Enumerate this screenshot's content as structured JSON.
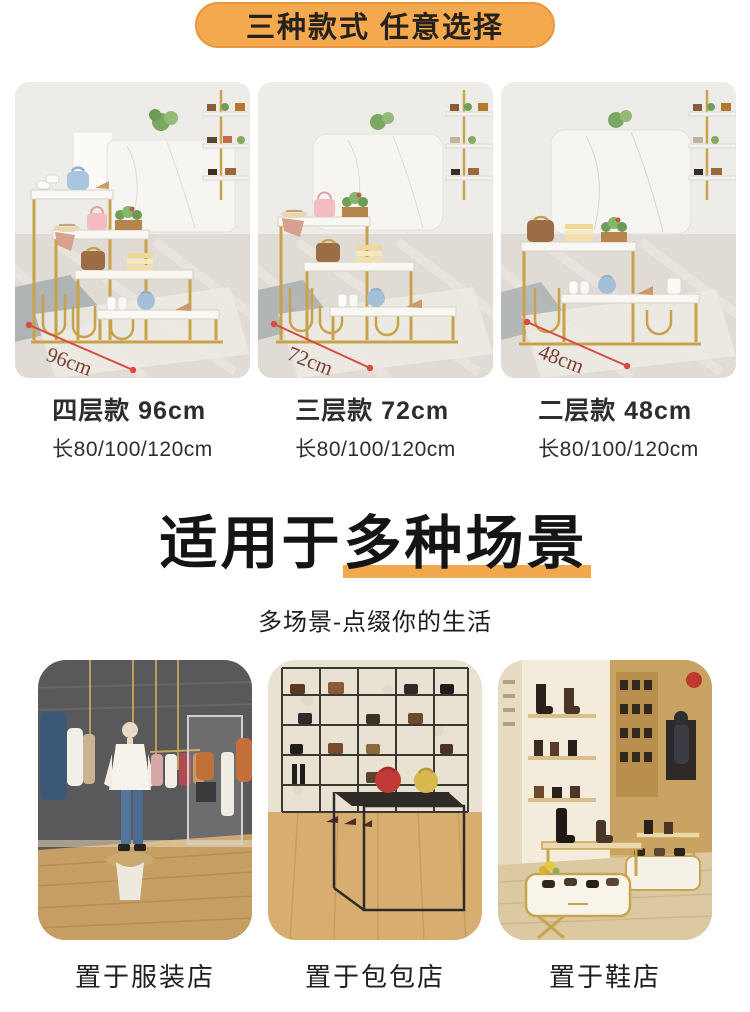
{
  "banner": {
    "text": "三种款式 任意选择"
  },
  "products": [
    {
      "name": "四层款 96cm",
      "size": "长80/100/120cm",
      "dimension": "96cm",
      "tiers": 4
    },
    {
      "name": "三层款 72cm",
      "size": "长80/100/120cm",
      "dimension": "72cm",
      "tiers": 3
    },
    {
      "name": "二层款 48cm",
      "size": "长80/100/120cm",
      "dimension": "48cm",
      "tiers": 2
    }
  ],
  "section": {
    "heading_plain": "适用于",
    "heading_highlight": "多种场景",
    "subtitle": "多场景-点缀你的生活"
  },
  "scenes": [
    {
      "label": "置于服装店"
    },
    {
      "label": "置于包包店"
    },
    {
      "label": "置于鞋店"
    }
  ],
  "colors": {
    "accent_orange": "#F4A94F",
    "banner_border": "#E8983C",
    "underline_orange": "#F2A94E",
    "dimension_red": "#D94B40",
    "rack_gold": "#C8A24B"
  }
}
